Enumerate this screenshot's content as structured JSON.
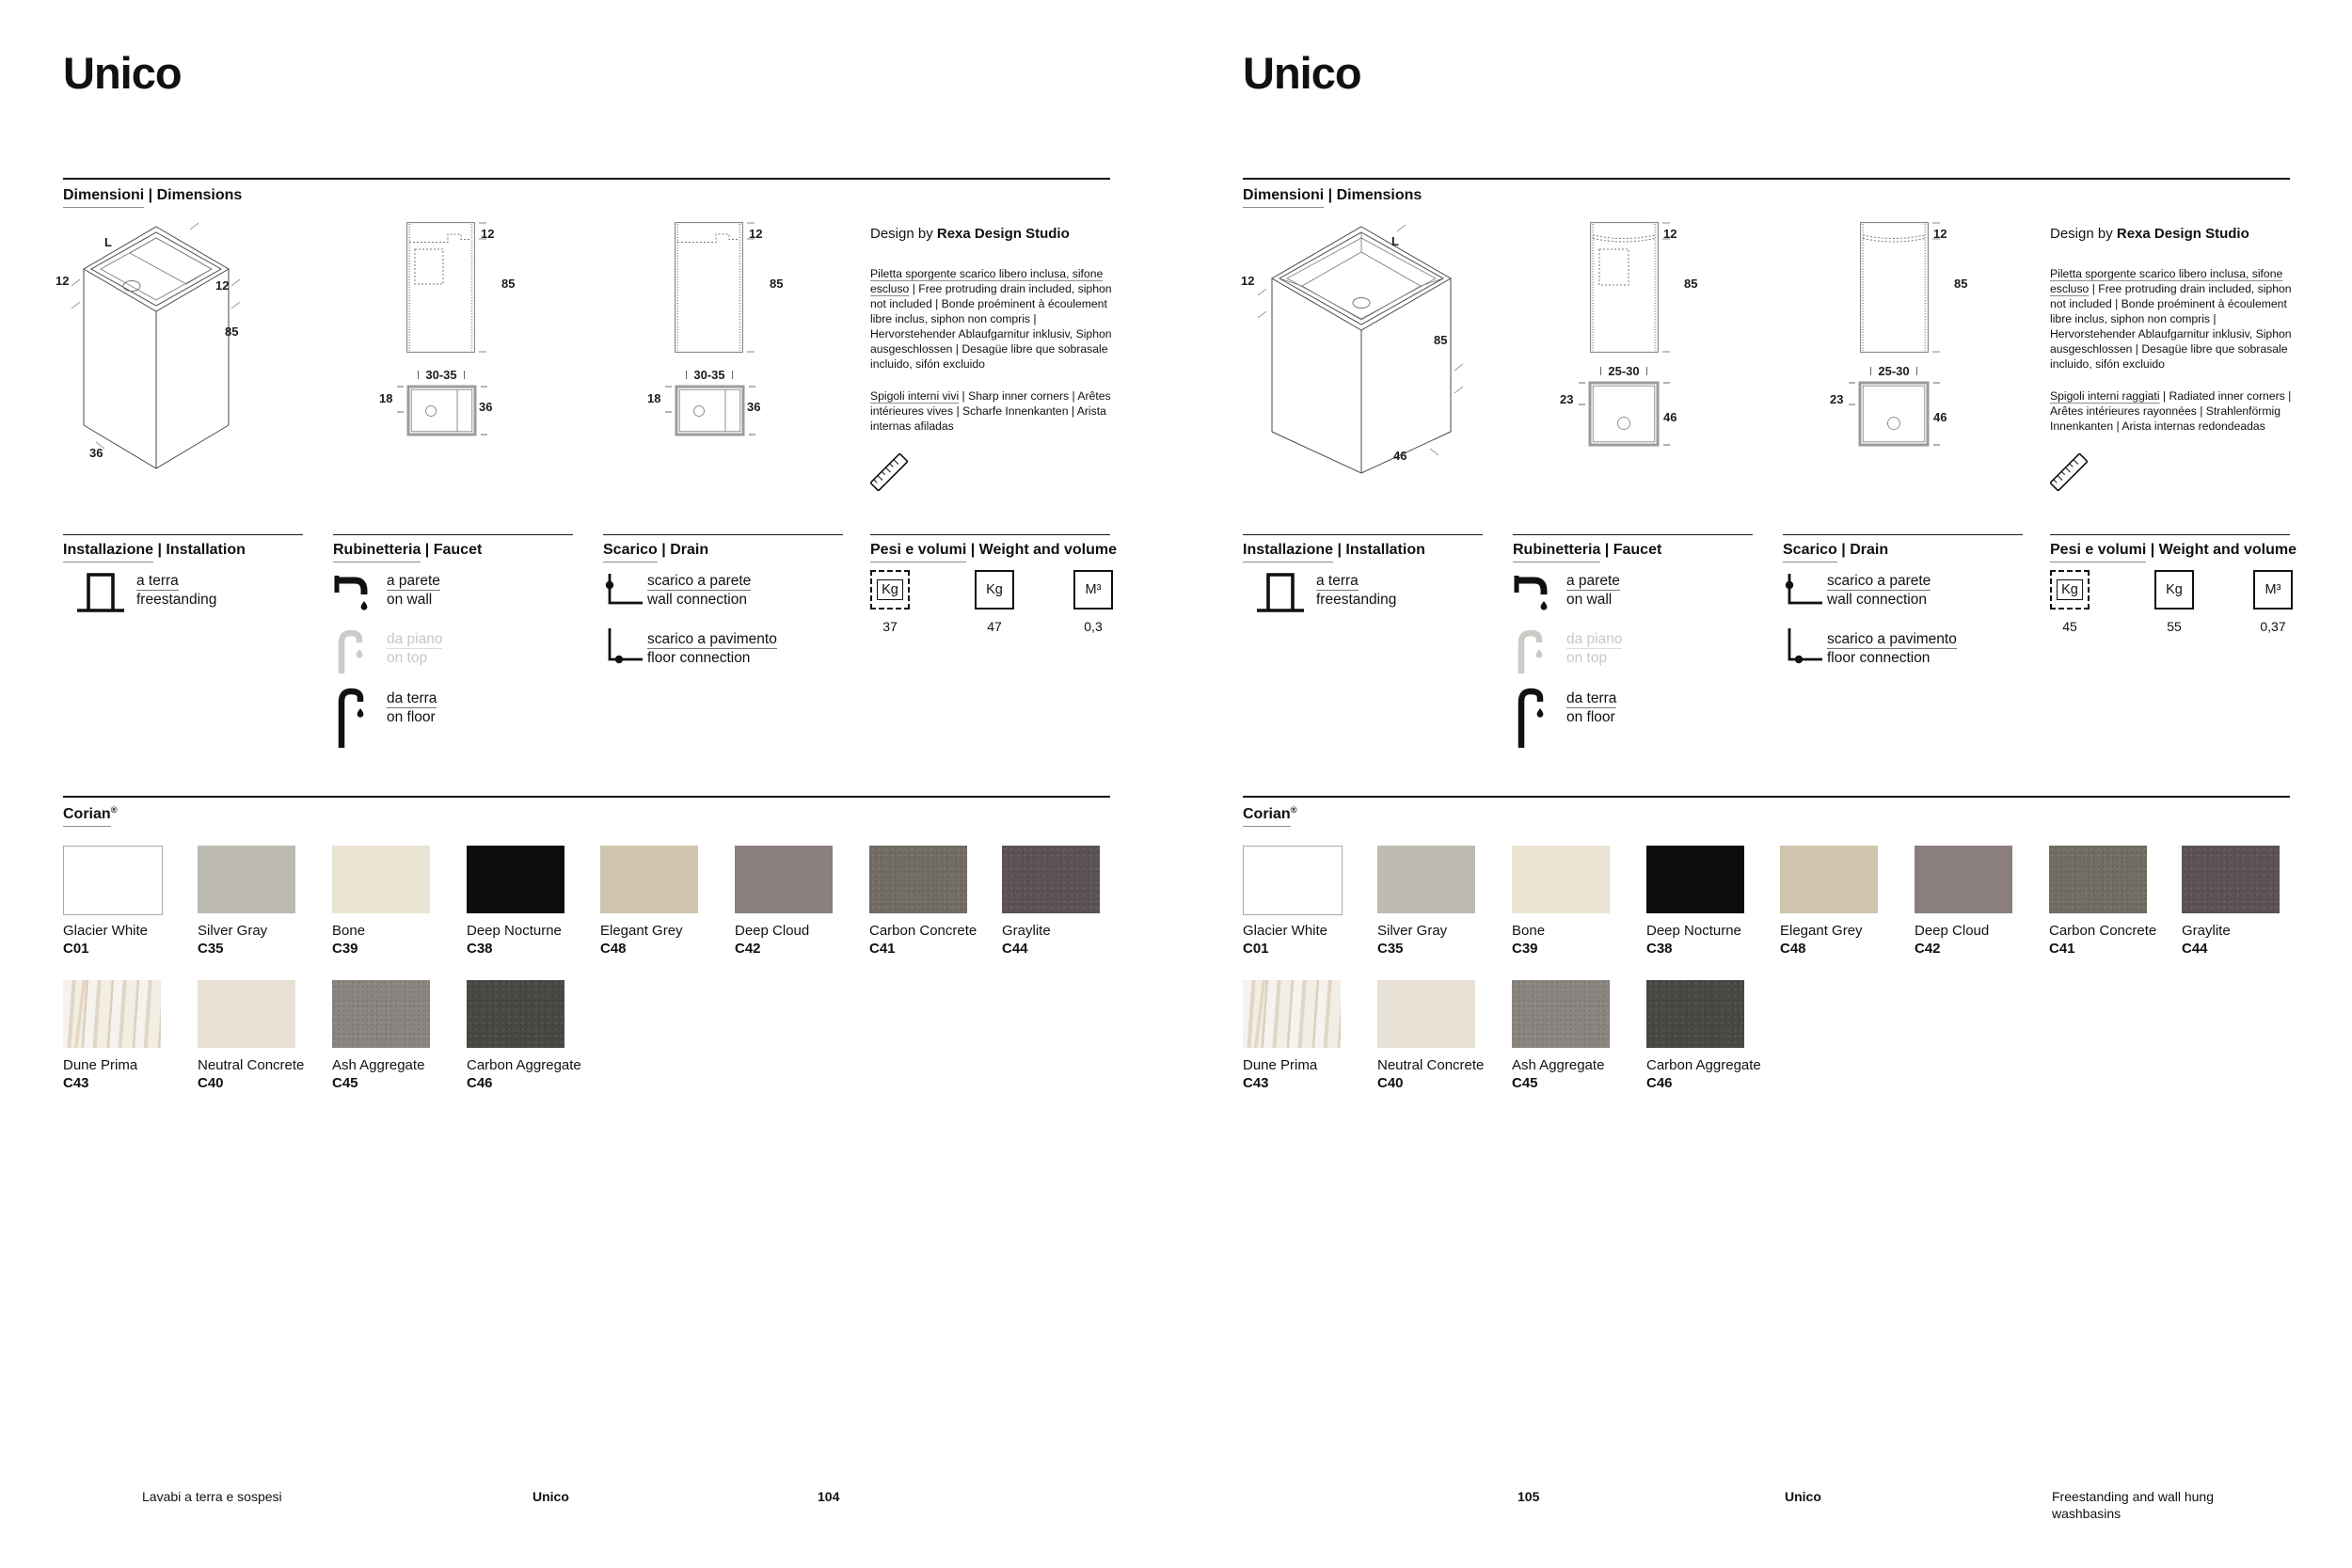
{
  "shared": {
    "corian_title": "Corian",
    "corian_reg": "®",
    "row1": [
      {
        "name": "Glacier White",
        "code": "C01",
        "hex": "#ffffff",
        "border": true
      },
      {
        "name": "Silver Gray",
        "code": "C35",
        "hex": "#bdbab2"
      },
      {
        "name": "Bone",
        "code": "C39",
        "hex": "#eae4d2"
      },
      {
        "name": "Deep Nocturne",
        "code": "C38",
        "hex": "#0d0d0d"
      },
      {
        "name": "Elegant Grey",
        "code": "C48",
        "hex": "#cfc4ae"
      },
      {
        "name": "Deep Cloud",
        "code": "C42",
        "hex": "#8a7f7c"
      },
      {
        "name": "Carbon Concrete",
        "code": "C41",
        "hex": "#736d63",
        "texture": true
      },
      {
        "name": "Graylite",
        "code": "C44",
        "hex": "#5c5358",
        "texture": true
      }
    ],
    "row2": [
      {
        "name": "Dune Prima",
        "code": "C43",
        "hex": "#ece5da",
        "texture": "marble"
      },
      {
        "name": "Neutral Concrete",
        "code": "C40",
        "hex": "#e8e1d5"
      },
      {
        "name": "Ash Aggregate",
        "code": "C45",
        "hex": "#8b8580",
        "texture": true
      },
      {
        "name": "Carbon Aggregate",
        "code": "C46",
        "hex": "#4a4845",
        "texture": true
      }
    ]
  },
  "left_page": {
    "title": "Unico",
    "dim_it": "Dimensioni",
    "dim_sep": " | ",
    "dim_en": "Dimensions",
    "design_prefix": "Design by ",
    "design_studio": "Rexa Design Studio",
    "note1_it": "Piletta sporgente scarico libero inclusa, sifone escluso",
    "note1_rest": " | Free protruding drain included, siphon not included | Bonde proéminent à écoulement libre inclus, siphon non compris | Hervorstehender Ablaufgarnitur inklusiv, Siphon ausgeschlossen | Desagüe libre que sobrasale incluido, sifón excluido",
    "note2_it": "Spigoli interni vivi",
    "note2_rest": " | Sharp inner corners | Arêtes intérieures vives | Scharfe Innenkanten | Arista internas afiladas",
    "iso": {
      "L": "L",
      "side_left": "12",
      "side_right": "12",
      "height": "85",
      "width": "36"
    },
    "front": {
      "thickness": "12",
      "height": "85"
    },
    "plan": {
      "span": "30-35",
      "offset": "18",
      "depth": "36"
    },
    "installation_it": "Installazione",
    "installation_en": "Installation",
    "inst_item_it": "a terra",
    "inst_item_en": "freestanding",
    "faucet_it": "Rubinetteria",
    "faucet_en": "Faucet",
    "faucet_items": [
      {
        "it": "a parete",
        "en": "on wall"
      },
      {
        "it": "da piano",
        "en": "on top"
      },
      {
        "it": "da terra",
        "en": "on floor"
      }
    ],
    "drain_it": "Scarico",
    "drain_en": "Drain",
    "drain_items": [
      {
        "it": "scarico a parete",
        "en": "wall connection"
      },
      {
        "it": "scarico a pavimento",
        "en": "floor connection"
      }
    ],
    "weights_it": "Pesi e volumi",
    "weights_en": "Weight and volume",
    "weights": [
      {
        "unit": "Kg",
        "value": "37"
      },
      {
        "unit": "Kg",
        "value": "47"
      },
      {
        "unit": "M³",
        "value": "0,3"
      }
    ],
    "footer": {
      "section": "Lavabi a terra e sospesi",
      "model": "Unico",
      "page": "104"
    }
  },
  "right_page": {
    "title": "Unico",
    "dim_it": "Dimensioni",
    "dim_sep": " | ",
    "dim_en": "Dimensions",
    "design_prefix": "Design by ",
    "design_studio": "Rexa Design Studio",
    "note1_it": "Piletta sporgente scarico libero inclusa, sifone escluso",
    "note1_rest": " | Free protruding drain included, siphon not included | Bonde proéminent à écoulement libre inclus, siphon non compris | Hervorstehender Ablaufgarnitur inklusiv, Siphon ausgeschlossen | Desagüe libre que sobrasale incluido, sifón excluido",
    "note2_it": "Spigoli interni raggiati",
    "note2_rest": " | Radiated inner corners | Arêtes intérieures rayonnées | Strahlenförmig Innenkanten | Arista internas redondeadas",
    "iso": {
      "L": "L",
      "side_left": "12",
      "height": "85",
      "width": "46"
    },
    "front": {
      "thickness": "12",
      "height": "85"
    },
    "plan": {
      "span": "25-30",
      "offset": "23",
      "depth": "46"
    },
    "installation_it": "Installazione",
    "installation_en": "Installation",
    "inst_item_it": "a terra",
    "inst_item_en": "freestanding",
    "faucet_it": "Rubinetteria",
    "faucet_en": "Faucet",
    "faucet_items": [
      {
        "it": "a parete",
        "en": "on wall"
      },
      {
        "it": "da piano",
        "en": "on top"
      },
      {
        "it": "da terra",
        "en": "on floor"
      }
    ],
    "drain_it": "Scarico",
    "drain_en": "Drain",
    "drain_items": [
      {
        "it": "scarico a parete",
        "en": "wall connection"
      },
      {
        "it": "scarico a pavimento",
        "en": "floor connection"
      }
    ],
    "weights_it": "Pesi e volumi",
    "weights_en": "Weight and volume",
    "weights": [
      {
        "unit": "Kg",
        "value": "45"
      },
      {
        "unit": "Kg",
        "value": "55"
      },
      {
        "unit": "M³",
        "value": "0,37"
      }
    ],
    "footer": {
      "page": "105",
      "model": "Unico",
      "caption1": "Freestanding and wall hung",
      "caption2": "washbasins"
    }
  }
}
